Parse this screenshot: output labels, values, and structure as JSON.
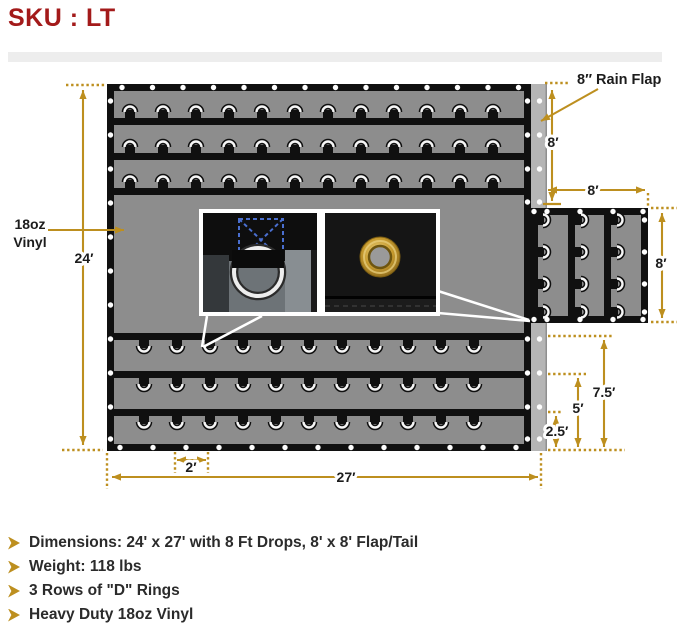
{
  "header": {
    "sku_label": "SKU : LT"
  },
  "diagram": {
    "labels": {
      "material_line1": "18oz",
      "material_line2": "Vinyl",
      "rain_flap": "8″ Rain Flap",
      "tarp_height": "24′",
      "tarp_width": "27′",
      "grommet_spacing": "2′",
      "drop_height": "8′",
      "flap_width": "8′",
      "flap_height": "8′",
      "ring_row_1": "2.5′",
      "ring_row_2": "5′",
      "ring_row_3": "7.5′"
    },
    "colors": {
      "gold": "#BD8F1F",
      "sku_red": "#A31A1A",
      "tarp_gray": "#8D8D8D",
      "tarp_black": "#101010",
      "rain_flap_gray": "#B5B5B5",
      "ring_white": "#F6F6F6",
      "stitch_blue": "#4A6FD0",
      "brass": "#C79B2E"
    }
  },
  "specs": {
    "items": [
      "Dimensions: 24' x 27' with 8 Ft Drops, 8' x 8' Flap/Tail",
      "Weight: 118 lbs",
      "3 Rows of \"D\" Rings",
      "Heavy Duty 18oz Vinyl"
    ]
  }
}
